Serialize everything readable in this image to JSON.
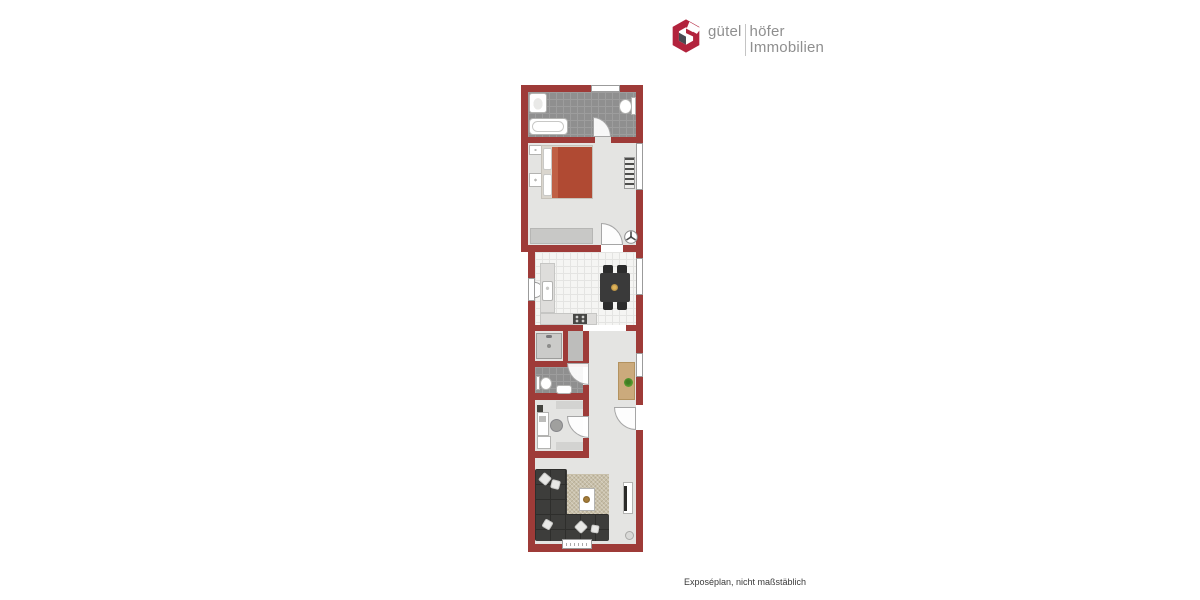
{
  "brand": {
    "name_left": "gütel",
    "name_right": "höfer",
    "name_line2": "Immobilien",
    "mark_color": "#b2233d",
    "mark_inner_color": "#4a4a52",
    "text_color": "#8f8f8f"
  },
  "footer": {
    "disclaimer": "Exposéplan, nicht maßstäblich"
  },
  "floorplan": {
    "wall_color": "#9e3b38",
    "floor_color": "#e4e4e2",
    "tile_dark_color": "#8f8f8f",
    "tile_light_color": "#f5f5f3",
    "bed_duvet_color": "#b04a33",
    "rug_color": "#c9c0a9",
    "wood_color": "#cbaa7c",
    "plant_color": "#4e8f2e",
    "rooms": [
      "bathroom",
      "bedroom",
      "kitchen",
      "shower-room",
      "wc",
      "hallway",
      "office",
      "living-room"
    ],
    "furniture": [
      "sink",
      "toilet",
      "bathtub",
      "bed",
      "nightstands",
      "wardrobe",
      "radiator",
      "ceiling-fan",
      "kitchen-counter",
      "stove",
      "dining-table",
      "chairs",
      "shower",
      "sideboard",
      "plant",
      "desk",
      "office-chair",
      "corner-sofa",
      "rug",
      "coffee-table",
      "tv-lowboard",
      "floor-lamp"
    ]
  }
}
